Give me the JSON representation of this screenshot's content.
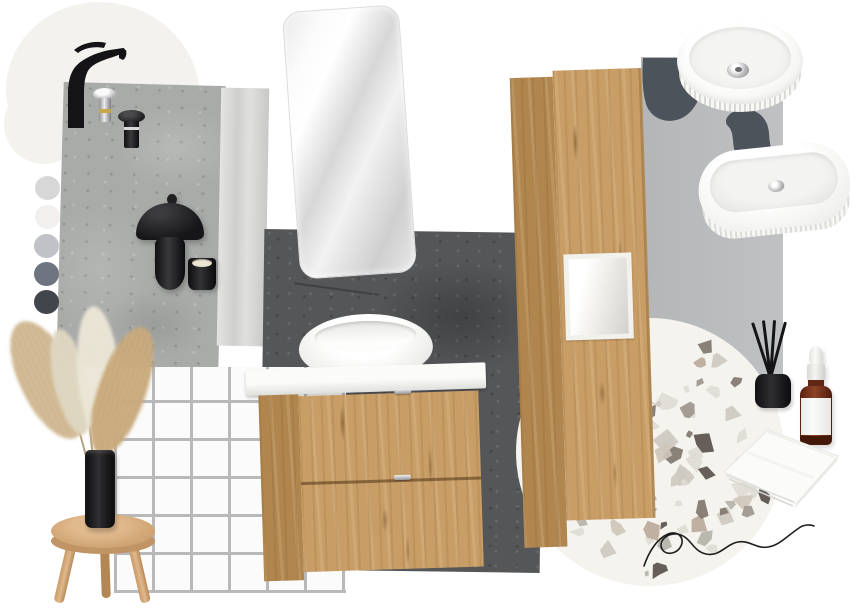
{
  "board": {
    "title": "bathroom interior mood board",
    "background": "#ffffff"
  },
  "palette": {
    "label": "grey tone swatches",
    "swatches": [
      {
        "name": "light-grey",
        "hex": "#d7d7d7"
      },
      {
        "name": "off-white",
        "hex": "#f1f0ee"
      },
      {
        "name": "silver-grey",
        "hex": "#c0c2c5"
      },
      {
        "name": "slate-grey",
        "hex": "#6e7480"
      },
      {
        "name": "charcoal",
        "hex": "#42454b"
      }
    ]
  },
  "materials": {
    "blob_offwhite": "#f4f2ee",
    "oak_wood": "#c89d66",
    "oak_wood_side": "#b0854e",
    "concrete_light": "#a9aba9",
    "stone_light": "#d5d5d3",
    "concrete_dark": "#545658",
    "wall_grey": "#bbbdbf",
    "paint_stroke_dark": "#4d535a",
    "tile_white": "#fbfbfb",
    "tile_grout": "#b7b9bb",
    "terrazzo_base": "#f5f3ee",
    "terrazzo_chips": [
      "#dedbd3",
      "#cdc9c0",
      "#b5b1a8",
      "#9b948b",
      "#7e756c",
      "#564f48",
      "#b9a898",
      "#cfc5b8"
    ],
    "ceramic_white": "#fbfbfa",
    "matte_black": "#1b1b1b",
    "chrome": "#b9b9b9",
    "brass": "#c9a84c",
    "amber_glass": "#7b3620",
    "pampas_beige": "#c9ae82",
    "pampas_cream": "#e9e3d2",
    "stool_wood": "#c09464"
  },
  "items": [
    {
      "id": "black-basin-faucet",
      "label": "Matte black tall basin mixer tap"
    },
    {
      "id": "chrome-popup-waste",
      "label": "Chrome pop-up drain waste"
    },
    {
      "id": "black-popup-waste",
      "label": "Black pop-up drain waste"
    },
    {
      "id": "concrete-panel",
      "label": "Light concrete wall panel"
    },
    {
      "id": "stone-panel",
      "label": "Light stone strip panel"
    },
    {
      "id": "wall-mirror",
      "label": "Rounded rectangle wall mirror"
    },
    {
      "id": "dark-concrete-panel",
      "label": "Dark concrete slate panel"
    },
    {
      "id": "mushroom-lamp",
      "label": "Black mushroom table lamp"
    },
    {
      "id": "black-candle",
      "label": "Black candle cup"
    },
    {
      "id": "tile-panel",
      "label": "White square mosaic tile panel"
    },
    {
      "id": "pampas-grass",
      "label": "Dried pampas grass"
    },
    {
      "id": "black-vase",
      "label": "Black cylinder vase"
    },
    {
      "id": "wooden-stool",
      "label": "Round wooden stool"
    },
    {
      "id": "vanity-unit",
      "label": "Oak vanity unit with round countertop basin"
    },
    {
      "id": "tall-cabinet",
      "label": "Tall oak cabinet with open shelf"
    },
    {
      "id": "grey-wall-panel",
      "label": "Grey wall panel"
    },
    {
      "id": "paint-stroke",
      "label": "Dark grey paint stroke"
    },
    {
      "id": "round-basin",
      "label": "Round fluted countertop basin"
    },
    {
      "id": "oval-basin",
      "label": "Oval fluted countertop basin"
    },
    {
      "id": "terrazzo-sample",
      "label": "Round terrazzo material sample"
    },
    {
      "id": "reed-diffuser",
      "label": "Black reed diffuser"
    },
    {
      "id": "dropper-bottle",
      "label": "Amber glass dropper bottle"
    },
    {
      "id": "folded-towel",
      "label": "White folded towel"
    },
    {
      "id": "signature",
      "label": "Handwritten squiggle"
    },
    {
      "id": "colour-palette",
      "label": "Grey colour palette"
    }
  ]
}
